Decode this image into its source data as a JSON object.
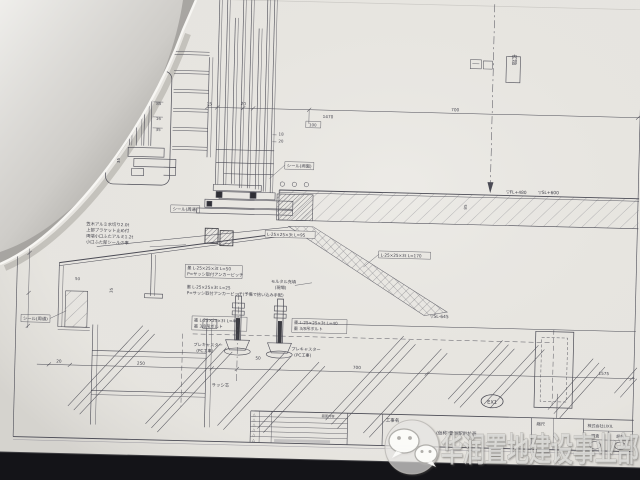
{
  "photo": {
    "watermark_text": "华润置地建设事业部",
    "watermark_icon": "wechat-icon"
  },
  "drawing": {
    "region_label": "内部",
    "levels": {
      "fl": "▽FL+480",
      "sl_top": "▽SL+600",
      "sl_bottom": "▽SL-645"
    },
    "grid_bubble": "EX1",
    "dims": {
      "d15": "15",
      "d20_top": "20",
      "d18": "18",
      "d20_mid": "20",
      "d100": "100",
      "d1470": "1470",
      "d700_top": "700",
      "d85_box": "85",
      "d16_box": "16",
      "d35_box1": "35",
      "d35_box2": "35",
      "d65": "65",
      "d40": "40",
      "d155": "155",
      "d50_flash": "50",
      "d35_wall": "35",
      "d85_slab": "85",
      "d20_bot": "20",
      "d250": "250",
      "d50_anchor": "50",
      "d700_bot": "700",
      "d1575": "1575"
    },
    "notes": {
      "seal_top": "シール(周通)",
      "seal_mid": "シール(両面)",
      "seal_bottom": "シール(周通)",
      "flash1": "笠木アルミ水切り2.0t",
      "flash2": "上部ブラケット止め付",
      "flash3": "両端小口ふたアルミ1.2t",
      "flash4": "小口ふた部シールの事",
      "angle95": "L-25×25×3t L=95",
      "angle170": "L-25×25×3t L=170",
      "pitch1a": "墨 L-25×25×3t L=50",
      "pitch1b": "P=サッシ取付アンカーピッチ",
      "pitch2a": "墨 L-25×25×3t L=25",
      "pitch2b": "P=サッシ取付アンカーピッチ(予備で拾い込み手配)",
      "mortar1": "モルタル充填",
      "mortar2": "(現場)",
      "boltL1": "墨 L-25×25×3t L=40",
      "boltL2": "墨 3/8吊ボルト",
      "boltR1": "墨 L-25×25×3t L=40",
      "boltR2": "墨 3/8吊ボルト",
      "precastL1": "プレキャスター",
      "precastL2": "(PC工事)",
      "precastR1": "プレキャスター",
      "precastR2": "(PC工事)",
      "sash_center": "サッシ芯"
    },
    "titleblock": {
      "project_label": "工事名",
      "project_name": "(仮称)豊洲駅前計画",
      "scale_label": "縮尺",
      "company": "株式会社LIXIL",
      "check": "照査",
      "design": "設計",
      "table_header": "図面内容",
      "rev_mark": "△"
    }
  },
  "colors": {
    "ink": "#4b4b55",
    "paper": "#e9e7e2",
    "shadow": "#17171b"
  }
}
